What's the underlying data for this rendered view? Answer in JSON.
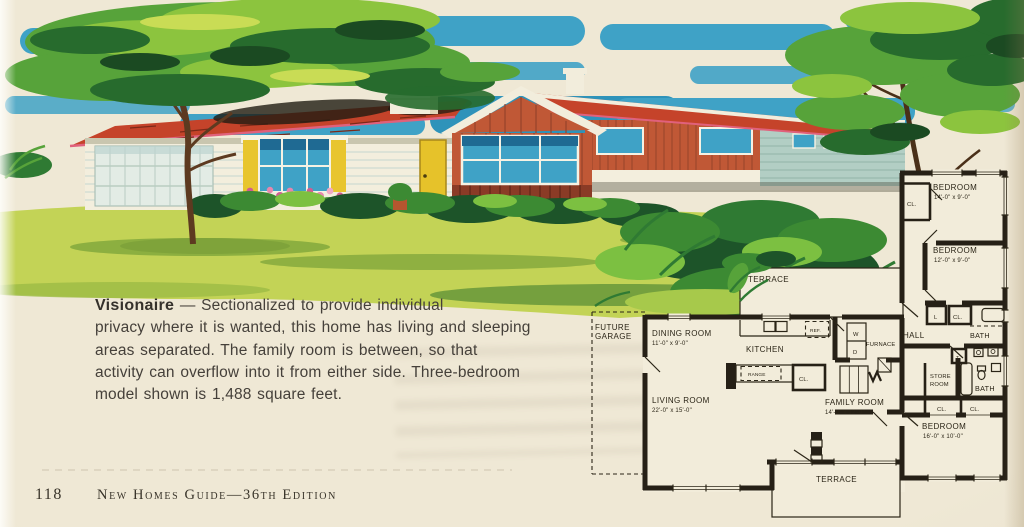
{
  "page": {
    "number": "118",
    "edition": "New Homes Guide—36th Edition"
  },
  "description": {
    "model_name": "Visionaire",
    "line1": " — Sectionalized to provide individual",
    "line2": "privacy where it is wanted, this home has living and sleeping",
    "line3": "areas separated. The family room is between, so that",
    "line4": "activity can overflow into it from either side. Three-bedroom",
    "line5": "model shown is 1,488 square feet."
  },
  "floor_plan": {
    "terrace": "TERRACE",
    "future_garage_line1": "FUTURE",
    "future_garage_line2": "GARAGE",
    "dining_room": {
      "name": "DINING ROOM",
      "dim": "11'-0\" x 9'-0\""
    },
    "kitchen": "KITCHEN",
    "ref": "REF.",
    "range": "RANGE",
    "washer": "W",
    "dryer": "D",
    "furnace": "FURNACE",
    "hall": "HALL",
    "linen": "L",
    "toilet": "T",
    "closet": "CL.",
    "store_room_line1": "STORE",
    "store_room_line2": "ROOM",
    "bath": "BATH",
    "living_room": {
      "name": "LIVING ROOM",
      "dim": "22'-0\" x 15'-0\""
    },
    "family_room": {
      "name": "FAMILY ROOM",
      "dim": "14'-0\" x 12'-0\""
    },
    "bedroom_1": {
      "name": "BEDROOM",
      "dim": "14'-0\" x 9'-0\""
    },
    "bedroom_2": {
      "name": "BEDROOM",
      "dim": "12'-0\" x 9'-0\""
    },
    "bedroom_3": {
      "name": "BEDROOM",
      "dim": "16'-0\" x 10'-0\""
    }
  },
  "colors": {
    "paper": "#efe8d5",
    "sky_blue": "#3fa2c6",
    "roof_red": "#c5432a",
    "siding_red": "#c05836",
    "door_yellow": "#e6c22a",
    "lawn_green": "#c3d356",
    "foliage_green": "#57a33a",
    "ink": "#2a2318"
  }
}
